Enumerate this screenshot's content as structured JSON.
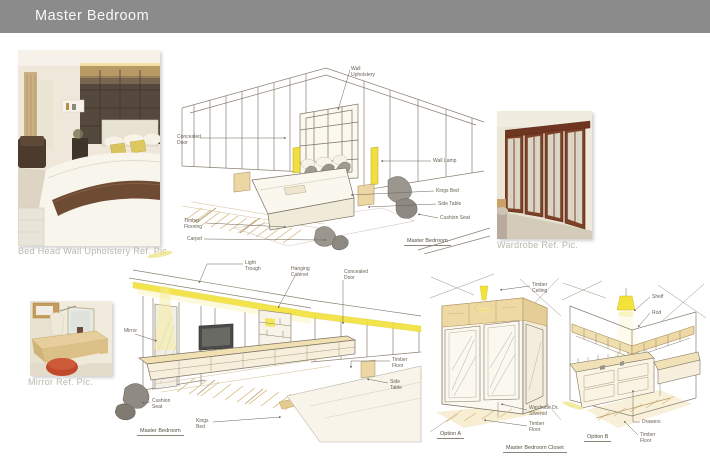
{
  "header": {
    "title": "Master Bedroom"
  },
  "ref_photos": {
    "bed_head": {
      "caption": "Bed Head Wall Upholstery Ref. Pic."
    },
    "wardrobe": {
      "caption": "Wardrobe Ref. Pic."
    },
    "mirror": {
      "caption": "Mirror Ref. Pic."
    }
  },
  "sketch_bedroom_view_1": {
    "caption": "Master Bedroom",
    "labels": {
      "wall_upholstery": "Wall Upholstery",
      "concealed_door": "Concealed Door",
      "wall_lamp": "Wall Lamp",
      "kings_bed": "Kings Bed",
      "side_table": "Side Table",
      "cushion_seat": "Cushion Seat",
      "timber_flooring": "Timber Flooring",
      "carpet": "Carpet"
    }
  },
  "sketch_bedroom_view_2": {
    "caption": "Master Bedroom",
    "labels": {
      "light_trough": "Light Trough",
      "hanging_cabinet": "Hanging Cabinet",
      "concealed_door": "Concealed Door",
      "mirror": "Mirror",
      "timber_floor": "Timber Floor",
      "side_table": "Side Table",
      "cushion_seat": "Cushion Seat",
      "kings_bed": "Kings Bed"
    }
  },
  "sketch_closet": {
    "caption": "Master Bedroom Closet",
    "option_a": {
      "name": "Option A",
      "labels": {
        "timber_ceiling": "Timber Ceiling",
        "wardrobe_door": "Wardrobe Dr. Silvered",
        "timber_floor": "Timber Floor"
      }
    },
    "option_b": {
      "name": "Option B",
      "labels": {
        "shelf": "Shelf",
        "rod": "Rod",
        "drawers": "Drawers",
        "timber_floor": "Timber Floor"
      }
    }
  },
  "colors": {
    "header_gray": "#8b8b8b",
    "accent_yellow": "#f2e23a",
    "timber_tan": "#ecd7a4",
    "sketch_line": "#8b8172",
    "caption_gray": "#b9b8a9"
  }
}
